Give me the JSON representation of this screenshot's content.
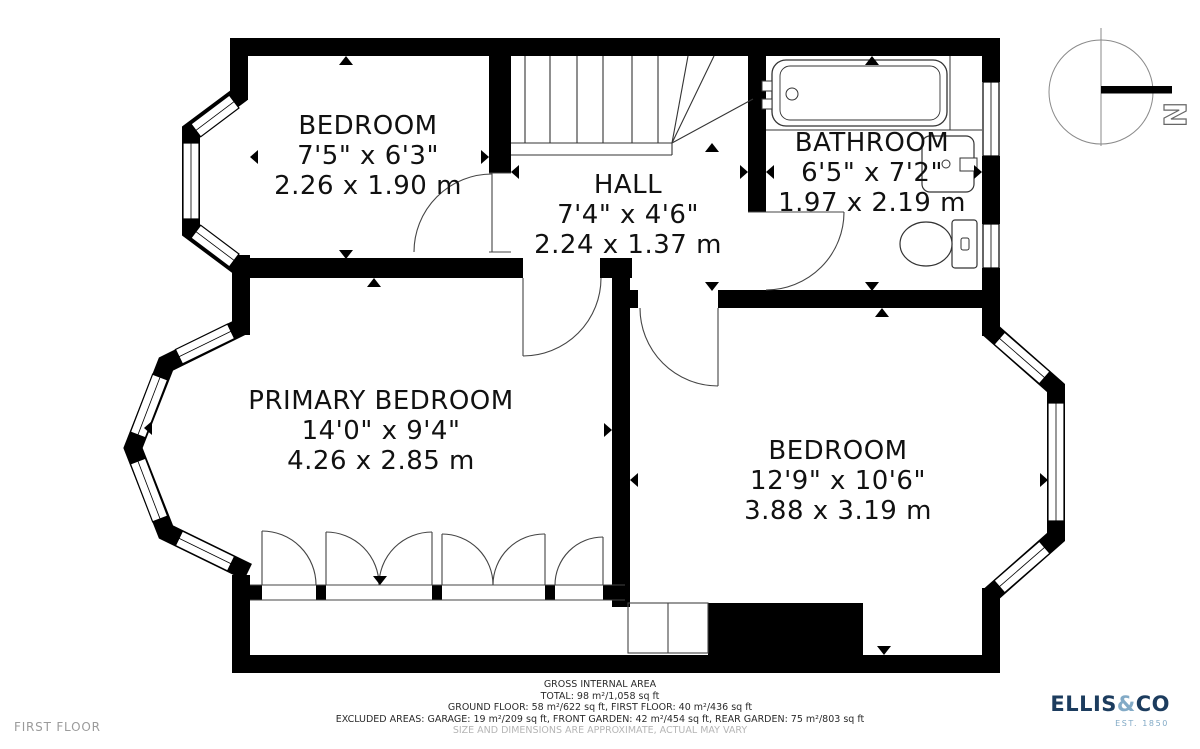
{
  "floor_label": "FIRST FLOOR",
  "compass": {
    "label": "N"
  },
  "rooms": [
    {
      "name": "BEDROOM",
      "imperial": "7'5\" x 6'3\"",
      "metric": "2.26 x 1.90 m"
    },
    {
      "name": "HALL",
      "imperial": "7'4\" x 4'6\"",
      "metric": "2.24 x 1.37 m"
    },
    {
      "name": "BATHROOM",
      "imperial": "6'5\" x 7'2\"",
      "metric": "1.97 x 2.19 m"
    },
    {
      "name": "PRIMARY BEDROOM",
      "imperial": "14'0\" x 9'4\"",
      "metric": "4.26 x 2.85 m"
    },
    {
      "name": "BEDROOM",
      "imperial": "12'9\" x 10'6\"",
      "metric": "3.88 x 3.19 m"
    }
  ],
  "footer": {
    "title": "GROSS INTERNAL AREA",
    "total": "TOTAL: 98 m²/1,058 sq ft",
    "floors": "GROUND FLOOR: 58 m²/622 sq ft, FIRST FLOOR: 40 m²/436 sq ft",
    "excluded": "EXCLUDED AREAS: GARAGE: 19 m²/209 sq ft, FRONT GARDEN: 42 m²/454 sq ft, REAR GARDEN: 75 m²/803 sq ft",
    "disclaimer": "SIZE AND DIMENSIONS ARE APPROXIMATE, ACTUAL MAY VARY"
  },
  "logo": {
    "name_primary": "ELLIS",
    "ampersand": "&",
    "name_secondary": "CO",
    "established": "EST. 1850"
  },
  "colors": {
    "wall": "#000000",
    "logo_navy": "#1c3c5e",
    "logo_blue": "#82aac6",
    "muted_gray": "#9b9b9b"
  }
}
